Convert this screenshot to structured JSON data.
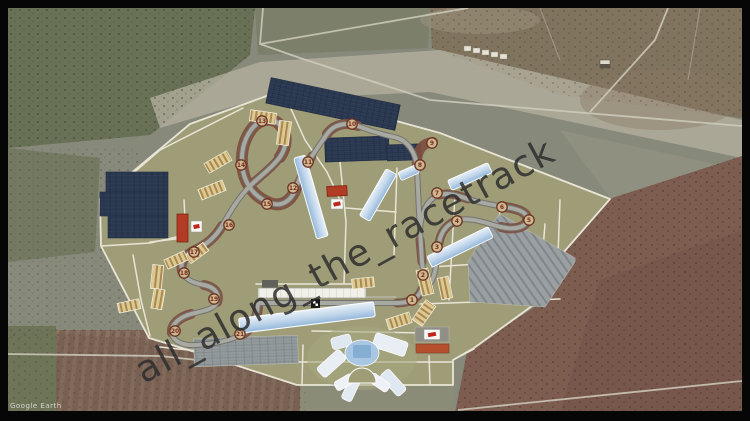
{
  "credit": {
    "text": "Google Earth"
  },
  "watermark": {
    "text": "all_along_the_racetrack",
    "color": "rgba(45,45,45,0.85)",
    "rotation_deg": -28.5
  },
  "colors": {
    "site": "#9e9d77",
    "site_pad": "#a6a580",
    "road": "#e9e5d6",
    "track": "#a9a9a3",
    "track_edge": "#73736d",
    "pitlane": "#bcbcb2",
    "runoff": "#7e4f40",
    "solar": "#2f3d56",
    "stand": "#dcc892",
    "stand_stripe": "#a9894f",
    "building_blue_light": "#e8f0f8",
    "building_blue_dark": "#93b7da",
    "building_red": "#b13b24",
    "building_red2": "#b5502d",
    "terrain_green": "#87897a",
    "terrain_scrub": "#687055",
    "terrain_brown": "#7d5d50",
    "pale_strip": "#b5b2a2",
    "dirt_road": "#cfccbc",
    "field_rows": "#7c6253"
  },
  "site_plan": {
    "label": "racetrack-master-plan-overlay",
    "corner_markers": [
      {
        "n": 1,
        "x": 412,
        "y": 300
      },
      {
        "n": 2,
        "x": 423,
        "y": 275
      },
      {
        "n": 3,
        "x": 437,
        "y": 247
      },
      {
        "n": 4,
        "x": 457,
        "y": 221
      },
      {
        "n": 5,
        "x": 529,
        "y": 220
      },
      {
        "n": 6,
        "x": 502,
        "y": 207
      },
      {
        "n": 7,
        "x": 437,
        "y": 193
      },
      {
        "n": 8,
        "x": 420,
        "y": 165
      },
      {
        "n": 9,
        "x": 432,
        "y": 143
      },
      {
        "n": 10,
        "x": 352,
        "y": 124
      },
      {
        "n": 11,
        "x": 308,
        "y": 162
      },
      {
        "n": 12,
        "x": 293,
        "y": 188
      },
      {
        "n": 13,
        "x": 262,
        "y": 121
      },
      {
        "n": 14,
        "x": 241,
        "y": 165
      },
      {
        "n": 15,
        "x": 267,
        "y": 204
      },
      {
        "n": 16,
        "x": 229,
        "y": 225
      },
      {
        "n": 17,
        "x": 194,
        "y": 252
      },
      {
        "n": 18,
        "x": 184,
        "y": 273
      },
      {
        "n": 19,
        "x": 214,
        "y": 299
      },
      {
        "n": 20,
        "x": 175,
        "y": 331
      },
      {
        "n": 21,
        "x": 240,
        "y": 334
      }
    ]
  }
}
